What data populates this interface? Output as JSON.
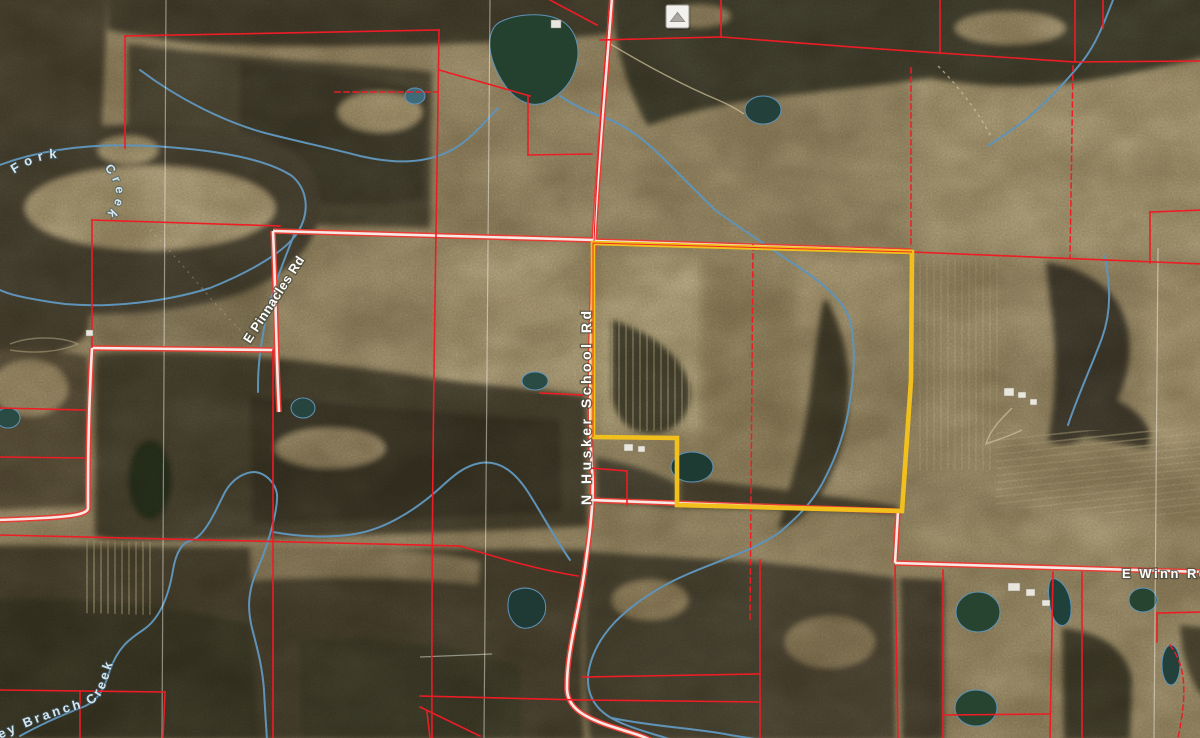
{
  "map": {
    "view": {
      "width": 1200,
      "height": 738,
      "description": "aerial parcel map"
    },
    "roads": {
      "pinnacles": {
        "label": "E Pinnacles Rd"
      },
      "husker": {
        "label": "N Husker School Rd"
      },
      "winn": {
        "label": "E Winn Rd"
      }
    },
    "waterways": {
      "fork_word": "Fork",
      "creek_word": "Creek",
      "branch": "ley Branch Creek"
    },
    "control_button": {
      "icon": "chevron-up-icon"
    },
    "colors": {
      "parcel_line": "#ee1c25",
      "highlight_parcel": "#f2c01d",
      "road_casing": "#e63d34",
      "road_fill": "#f7eae5",
      "water": "#5f93b8",
      "water_label": "#d4e7f1",
      "road_label": "#ffffff",
      "section_line": "rgba(255,255,248,0.45)"
    }
  }
}
